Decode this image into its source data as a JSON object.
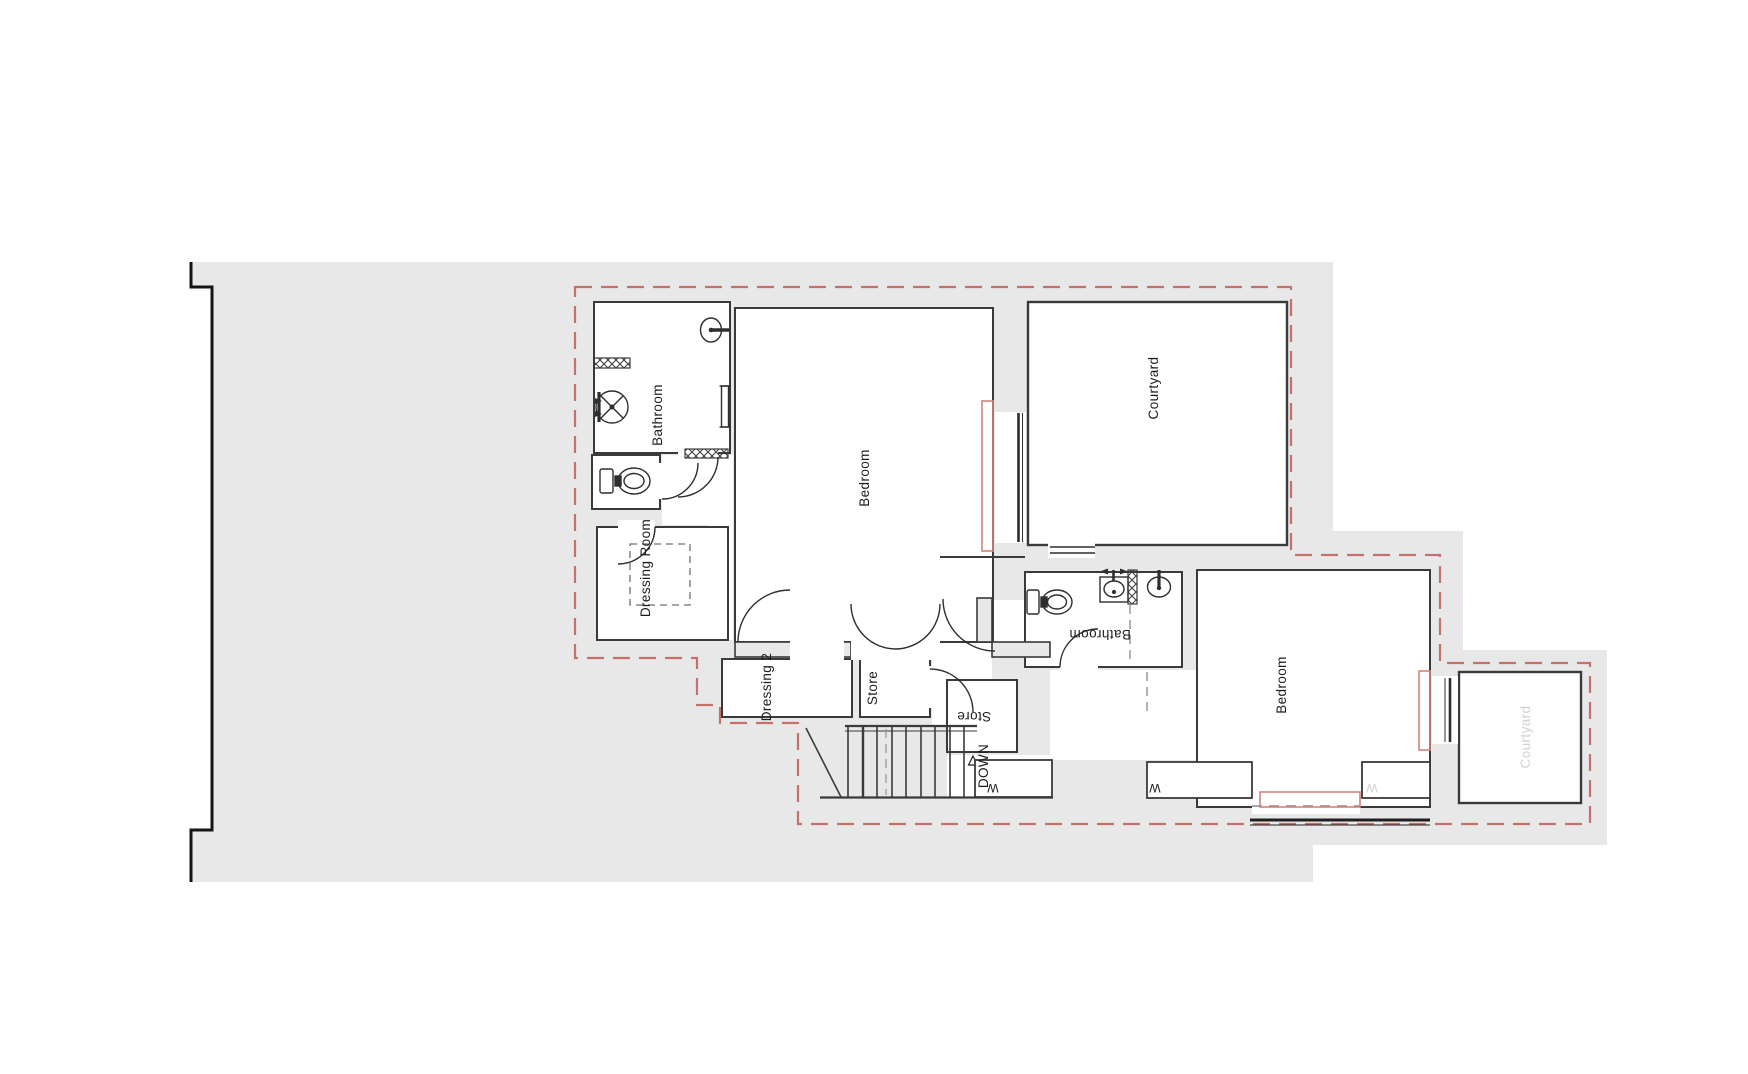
{
  "drawing": {
    "type": "architectural-floor-plan",
    "rooms": {
      "bathroom1": {
        "label": "Bathroom"
      },
      "bedroom1": {
        "label": "Bedroom"
      },
      "courtyard1": {
        "label": "Courtyard"
      },
      "dressing_room": {
        "label": "Dressing Room"
      },
      "dressing2": {
        "label": "Dressing 2"
      },
      "store1": {
        "label": "Store"
      },
      "stairs": {
        "label": "DOWN"
      },
      "bathroom2": {
        "label": "Bathroom"
      },
      "store2": {
        "label": "Store"
      },
      "wardrobe_hall": {
        "label": "W"
      },
      "wardrobe_left": {
        "label": "W"
      },
      "wardrobe_right": {
        "label": "W"
      },
      "bedroom2": {
        "label": "Bedroom"
      },
      "courtyard2": {
        "label": "Courtyard"
      }
    },
    "colors": {
      "site_fill": "#e8e8e8",
      "wall_stroke": "#3a3a3a",
      "outline_black": "#151515",
      "boundary_red": "#c4716b",
      "marker_red": "#d4837c",
      "light_label": "#cfd2cf",
      "label": "#1c1c1c"
    }
  }
}
